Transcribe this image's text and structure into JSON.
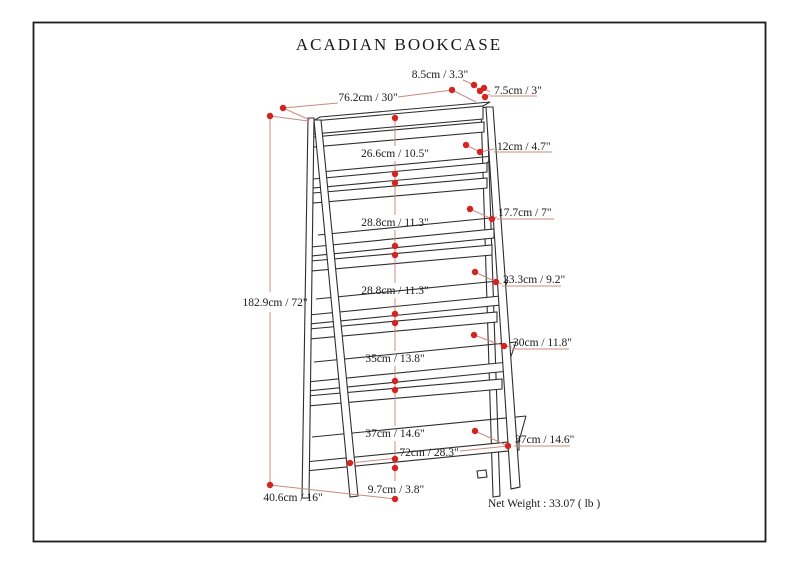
{
  "title": "ACADIAN BOOKCASE",
  "colors": {
    "dimension_dot": "#d42420",
    "dimension_line": "#c98b80",
    "drawing_line": "#2e2e2e"
  },
  "dimensions": {
    "total_height": "182.9cm / 72\"",
    "top_width": "76.2cm / 30\"",
    "top_rail_height": "8.5cm / 3.3\"",
    "frame_thickness": "7.5cm / 3\"",
    "base_depth": "40.6cm / 16\"",
    "bottom_width": "72cm / 28.3\"",
    "floor_clearance": "9.7cm / 3.8\"",
    "shelf_spacings": [
      "26.6cm / 10.5\"",
      "28.8cm / 11.3\"",
      "28.8cm / 11.3\"",
      "35cm / 13.8\"",
      "37cm / 14.6\""
    ],
    "shelf_depths": [
      "12cm / 4.7\"",
      "17.7cm / 7\"",
      "23.3cm / 9.2\"",
      "30cm / 11.8\"",
      "37cm / 14.6\""
    ]
  },
  "footer": {
    "net_weight": "Net Weight : 33.07 ( lb )"
  }
}
